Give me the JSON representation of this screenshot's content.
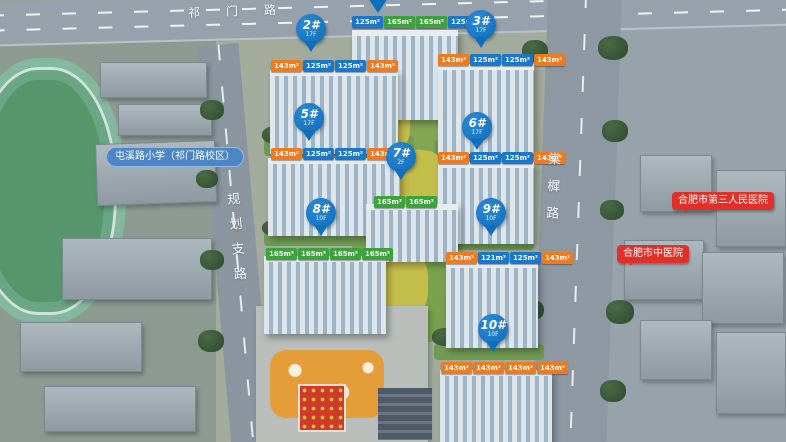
{
  "map": {
    "roads": {
      "top_label": "祁门路",
      "left_label": "规划支路",
      "right_label": "棠樨路"
    },
    "pois": {
      "school_label": "屯溪路小学（祁门路校区）",
      "hospital_east_label": "合肥市第三人民医院",
      "hospital_south_label": "合肥市中医院"
    },
    "colors": {
      "pin_blue": "#0f6fbc",
      "tag_orange": "#ef7a1f",
      "tag_blue": "#1b77c9",
      "tag_green": "#3da23c",
      "poi_pill_blue": "#4c86c6",
      "poi_bubble_red": "#e23028"
    },
    "buildings": [
      {
        "tags": [
          {
            "area": "125m²",
            "color": "blue"
          },
          {
            "area": "165m²",
            "color": "green"
          },
          {
            "area": "165m²",
            "color": "green"
          },
          {
            "area": "125m²",
            "color": "blue"
          }
        ]
      },
      {
        "pin": "2#",
        "floors": "17F",
        "tags": [
          {
            "area": "143m²",
            "color": "orange"
          },
          {
            "area": "125m²",
            "color": "blue"
          },
          {
            "area": "125m²",
            "color": "blue"
          },
          {
            "area": "143m²",
            "color": "orange"
          }
        ]
      },
      {
        "pin": "3#",
        "floors": "17F",
        "tags": [
          {
            "area": "143m²",
            "color": "orange"
          },
          {
            "area": "125m²",
            "color": "blue"
          },
          {
            "area": "125m²",
            "color": "blue"
          },
          {
            "area": "143m²",
            "color": "orange"
          }
        ]
      },
      {
        "pin": "5#",
        "floors": "17F",
        "tags": [
          {
            "area": "143m²",
            "color": "orange"
          },
          {
            "area": "125m²",
            "color": "blue"
          },
          {
            "area": "125m²",
            "color": "blue"
          },
          {
            "area": "143m²",
            "color": "orange"
          }
        ]
      },
      {
        "pin": "6#",
        "floors": "17F",
        "tags": [
          {
            "area": "143m²",
            "color": "orange"
          },
          {
            "area": "125m²",
            "color": "blue"
          },
          {
            "area": "125m²",
            "color": "blue"
          },
          {
            "area": "143m²",
            "color": "orange"
          }
        ]
      },
      {
        "pin": "7#",
        "floors": "2F",
        "tags": [
          {
            "area": "165m²",
            "color": "green"
          },
          {
            "area": "165m²",
            "color": "green"
          }
        ]
      },
      {
        "pin": "8#",
        "floors": "10F",
        "tags": [
          {
            "area": "165m²",
            "color": "green"
          },
          {
            "area": "165m²",
            "color": "green"
          },
          {
            "area": "165m²",
            "color": "green"
          },
          {
            "area": "165m²",
            "color": "green"
          }
        ]
      },
      {
        "pin": "9#",
        "floors": "10F",
        "tags": [
          {
            "area": "143m²",
            "color": "orange"
          },
          {
            "area": "121m²",
            "color": "blue"
          },
          {
            "area": "125m²",
            "color": "blue"
          },
          {
            "area": "143m²",
            "color": "orange"
          }
        ]
      },
      {
        "pin": "10#",
        "floors": "10F",
        "tags": [
          {
            "area": "143m²",
            "color": "orange"
          },
          {
            "area": "143m²",
            "color": "orange"
          },
          {
            "area": "143m²",
            "color": "orange"
          },
          {
            "area": "143m²",
            "color": "orange"
          }
        ]
      }
    ]
  }
}
